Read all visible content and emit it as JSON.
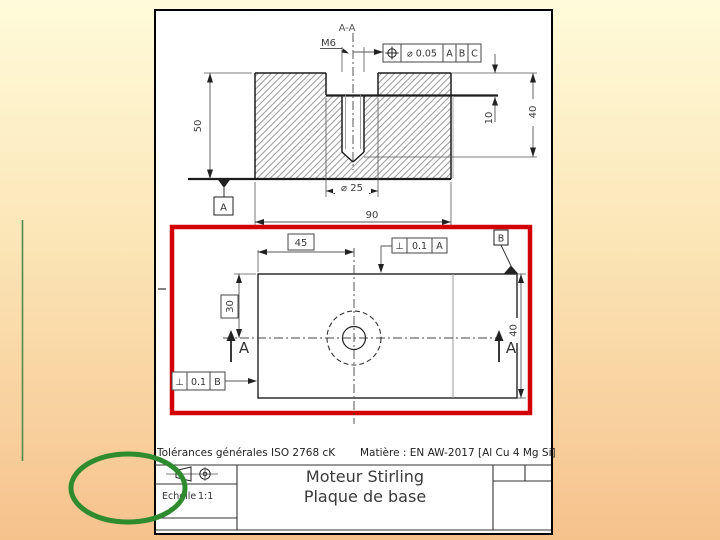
{
  "slide": {
    "bg_top": "#FFFBDA",
    "bg_mid": "#FBE5B6",
    "bg_bottom": "#F6C28C"
  },
  "annotations": {
    "highlight_color": "#D30000",
    "circle_color": "#2E8B2E",
    "line_color": "#4F8A4F"
  },
  "section_view": {
    "label": "A-A",
    "thread_callout": "M6",
    "position_fcf": {
      "tolerance": "⌀ 0.05",
      "datums": [
        "A",
        "B",
        "C"
      ]
    },
    "dims": {
      "height": "50",
      "cbore_depth": "10",
      "hole_depth": "40",
      "cbore_dia": "⌀ 25",
      "width": "90"
    },
    "datum": "A"
  },
  "plan_view": {
    "dims": {
      "hole_x": "45",
      "hole_y": "30",
      "depth": "40"
    },
    "perp_fcf_top": {
      "symbol": "⊥",
      "tolerance": "0.1",
      "datum": "A"
    },
    "perp_fcf_left": {
      "symbol": "⊥",
      "tolerance": "0.1",
      "datum": "B"
    },
    "datum": "B",
    "section_arrow_left": "A",
    "section_arrow_right": "A"
  },
  "title_block": {
    "tolerances": "Tolérances générales ISO 2768 cK",
    "material": "Matière : EN AW-2017 [Al Cu 4 Mg Si]",
    "scale_label": "Echelle",
    "scale_value": "1:1",
    "title_line1": "Moteur Stirling",
    "title_line2": "Plaque de base"
  }
}
